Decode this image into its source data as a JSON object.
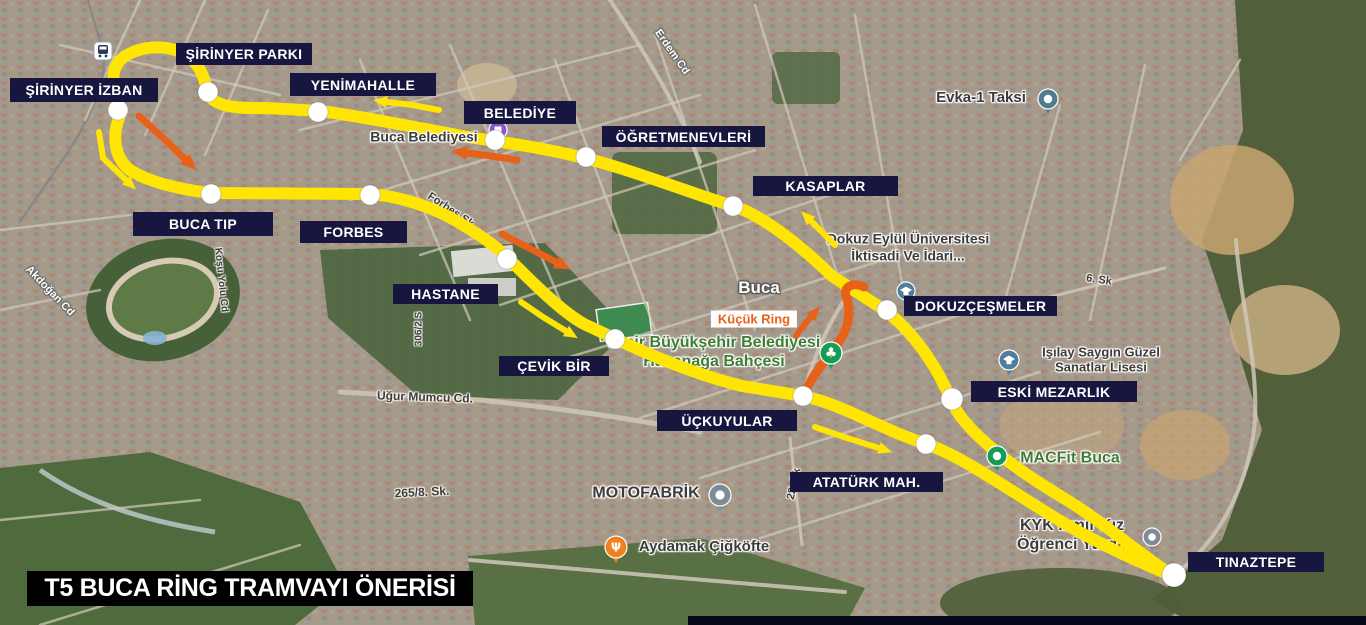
{
  "title_bar": {
    "text": "T5 BUCA RİNG TRAMVAYI ÖNERİSİ",
    "bg": "#000000",
    "fg": "#FFFFFF"
  },
  "colors": {
    "route_yellow": "#FFE504",
    "route_orange": "#E8611A",
    "station_box": "#16163F",
    "station_text": "#FFFFFF",
    "poi_green": "#3E7D33",
    "kucuk_ring_bg": "#FFFFFF"
  },
  "route": {
    "width": 12,
    "north_path": "M122,111 C112,92 108,68 124,57 C142,45 168,44 186,55 C200,64 204,77 208,92 C211,105 232,109 266,108 L321,111 C365,117 425,129 462,136 L494,141 C522,145 556,151 584,158 C624,167 702,197 733,206 C760,214 798,243 832,276 L886,311 C912,331 936,364 951,400 C964,431 1012,467 1062,497 C1102,521 1142,556 1173,576",
    "south_path": "M122,111 C112,131 112,156 130,170 C148,182 182,190 211,193 L371,194 C402,197 433,207 458,222 C483,237 497,247 509,259 C532,282 562,312 584,324 L616,339 C652,356 694,374 742,386 L803,396 C842,404 878,428 926,444 C962,456 1012,492 1062,522 C1102,546 1144,564 1173,576",
    "kucuk_ring": {
      "width": 9,
      "path": "M803,397 C812,374 828,358 840,340 C851,324 850,306 846,296 C843,288 852,281 864,287",
      "label": {
        "text": "Küçük Ring",
        "x": 754,
        "y": 319
      }
    }
  },
  "stations": [
    {
      "id": "sirinyer-izban",
      "name": "ŞİRİNYER İZBAN",
      "box": [
        10,
        78,
        148,
        24
      ],
      "dot": [
        118,
        110
      ]
    },
    {
      "id": "sirinyer-parki",
      "name": "ŞİRİNYER PARKI",
      "box": [
        176,
        43,
        136,
        22
      ],
      "dot": [
        208,
        92
      ]
    },
    {
      "id": "yenimahalle",
      "name": "YENİMAHALLE",
      "box": [
        290,
        73,
        146,
        23
      ],
      "dot": [
        318,
        112
      ]
    },
    {
      "id": "belediye",
      "name": "BELEDİYE",
      "box": [
        464,
        101,
        112,
        23
      ],
      "dot": [
        495,
        140
      ]
    },
    {
      "id": "ogretmenevleri",
      "name": "ÖĞRETMENEVLERİ",
      "box": [
        602,
        126,
        163,
        21
      ],
      "dot": [
        586,
        157
      ]
    },
    {
      "id": "kasaplar",
      "name": "KASAPLAR",
      "box": [
        753,
        176,
        145,
        20
      ],
      "dot": [
        733,
        206
      ]
    },
    {
      "id": "buca-tip",
      "name": "BUCA TIP",
      "box": [
        133,
        212,
        140,
        24
      ],
      "dot": [
        211,
        194
      ]
    },
    {
      "id": "forbes",
      "name": "FORBES",
      "box": [
        300,
        221,
        107,
        22
      ],
      "dot": [
        370,
        195
      ]
    },
    {
      "id": "hastane",
      "name": "HASTANE",
      "box": [
        393,
        284,
        105,
        20
      ],
      "dot": [
        507,
        259
      ]
    },
    {
      "id": "cevik-bir",
      "name": "ÇEVİK BİR",
      "box": [
        499,
        356,
        110,
        20
      ],
      "dot": [
        615,
        339
      ]
    },
    {
      "id": "uckuyular",
      "name": "ÜÇKUYULAR",
      "box": [
        657,
        410,
        140,
        21
      ],
      "dot": [
        803,
        396
      ]
    },
    {
      "id": "ataturk-mah",
      "name": "ATATÜRK MAH.",
      "box": [
        790,
        472,
        153,
        20
      ],
      "dot": [
        926,
        444
      ]
    },
    {
      "id": "dokuzcesmeler",
      "name": "DOKUZÇEŞMELER",
      "box": [
        904,
        296,
        153,
        20
      ],
      "dot": [
        887,
        310
      ]
    },
    {
      "id": "eski-mezarlik",
      "name": "ESKİ MEZARLIK",
      "box": [
        971,
        381,
        166,
        21
      ],
      "dot": [
        952,
        399
      ],
      "r": 11
    },
    {
      "id": "tinaztepe",
      "name": "TINAZTEPE",
      "box": [
        1188,
        552,
        136,
        20
      ],
      "dot": [
        1174,
        575
      ],
      "r": 12
    }
  ],
  "arrows": [
    {
      "id": "izban-loop-arrow-yellow",
      "color": "yellow",
      "w": 6,
      "pts": [
        [
          99,
          132
        ],
        [
          103,
          158
        ],
        [
          126,
          180
        ]
      ]
    },
    {
      "id": "yenimahalle-left-arrow-yellow",
      "color": "yellow",
      "w": 6,
      "pts": [
        [
          439,
          110
        ],
        [
          412,
          105
        ],
        [
          387,
          102
        ]
      ]
    },
    {
      "id": "kasaplar-up-arrow-yellow",
      "color": "yellow",
      "w": 6,
      "pts": [
        [
          835,
          245
        ],
        [
          823,
          233
        ],
        [
          811,
          221
        ]
      ]
    },
    {
      "id": "hastane-down-arrow-yellow",
      "color": "yellow",
      "w": 6,
      "pts": [
        [
          521,
          302
        ],
        [
          543,
          317
        ],
        [
          566,
          331
        ]
      ]
    },
    {
      "id": "ataturk-right-arrow-yellow",
      "color": "yellow",
      "w": 6,
      "pts": [
        [
          815,
          427
        ],
        [
          847,
          438
        ],
        [
          879,
          448
        ]
      ]
    },
    {
      "id": "sirinyer-down-arrow-orange",
      "color": "orange",
      "w": 7,
      "pts": [
        [
          139,
          116
        ],
        [
          161,
          136
        ],
        [
          185,
          159
        ]
      ]
    },
    {
      "id": "belediye-left-arrow-orange",
      "color": "orange",
      "w": 7,
      "pts": [
        [
          517,
          160
        ],
        [
          491,
          156
        ],
        [
          467,
          153
        ]
      ]
    },
    {
      "id": "forbes-down-arrow-orange",
      "color": "orange",
      "w": 7,
      "pts": [
        [
          502,
          234
        ],
        [
          529,
          248
        ],
        [
          556,
          262
        ]
      ]
    },
    {
      "id": "kucukring-up-arrow-orange",
      "color": "orange",
      "w": 6,
      "pts": [
        [
          796,
          336
        ],
        [
          804,
          325
        ],
        [
          811,
          317
        ]
      ]
    }
  ],
  "map_pois": [
    {
      "id": "buca-belediyesi-label",
      "lines": [
        "Buca Belediyesi"
      ],
      "x": 424,
      "y": 137,
      "size": 14,
      "variant": "dark",
      "above": true
    },
    {
      "id": "evka1-taksi-label",
      "lines": [
        "Evka-1 Taksi"
      ],
      "x": 981,
      "y": 98,
      "size": 15,
      "variant": "dark"
    },
    {
      "id": "deu-iktisadi-label",
      "lines": [
        "Dokuz Eylül Üniversitesi",
        "İktisadi Ve İdari..."
      ],
      "x": 908,
      "y": 247,
      "size": 14,
      "variant": "dark"
    },
    {
      "id": "buca-district-label",
      "lines": [
        "Buca"
      ],
      "x": 759,
      "y": 288,
      "size": 17,
      "variant": "light"
    },
    {
      "id": "isilay-saygin-label",
      "lines": [
        "Işılay Saygın Güzel",
        "Sanatlar Lisesi"
      ],
      "x": 1101,
      "y": 360,
      "size": 13,
      "variant": "dark"
    },
    {
      "id": "hasanaga-bahcesi-label",
      "lines": [
        "İzmir Büyükşehir Belediyesi",
        "Hasanağa Bahçesi"
      ],
      "x": 714,
      "y": 353,
      "size": 16,
      "variant": "green"
    },
    {
      "id": "macfit-buca-label",
      "lines": [
        "MACFit Buca"
      ],
      "x": 1070,
      "y": 459,
      "size": 16,
      "variant": "green"
    },
    {
      "id": "kyk-yurdu-label",
      "lines": [
        "KYK İzmir Kız",
        "Öğrenci Yurdu"
      ],
      "x": 1072,
      "y": 536,
      "size": 16,
      "variant": "dark"
    },
    {
      "id": "motofabrik-label",
      "lines": [
        "MOTOFABRİK"
      ],
      "x": 646,
      "y": 494,
      "size": 16,
      "variant": "dark"
    },
    {
      "id": "aydamak-label",
      "lines": [
        "Aydamak Çiğköfte"
      ],
      "x": 704,
      "y": 547,
      "size": 15,
      "variant": "dark"
    }
  ],
  "streets": [
    {
      "id": "erdem-cd",
      "text": "Erdem Cd",
      "x": 672,
      "y": 52,
      "angle": 55,
      "variant": "light",
      "size": 11
    },
    {
      "id": "akdogan-cd",
      "text": "Akdoğan Cd",
      "x": 50,
      "y": 291,
      "angle": 46,
      "variant": "light",
      "size": 11
    },
    {
      "id": "kosu-yolu-cd",
      "text": "Koşu Yolu Cd",
      "x": 221,
      "y": 280,
      "angle": 84,
      "variant": "dark",
      "size": 10
    },
    {
      "id": "forbes-sk",
      "text": "Forbes Sk.",
      "x": 452,
      "y": 211,
      "angle": 34,
      "variant": "dark",
      "size": 11
    },
    {
      "id": "street-306-2",
      "text": "306/2 S",
      "x": 419,
      "y": 329,
      "angle": -90,
      "variant": "dark",
      "size": 10
    },
    {
      "id": "ugur-mumcu-cd",
      "text": "Uğur Mumcu Cd.",
      "x": 425,
      "y": 397,
      "angle": 2,
      "variant": "dark",
      "size": 12
    },
    {
      "id": "street-265-8",
      "text": "265/8. Sk.",
      "x": 422,
      "y": 492,
      "angle": -3,
      "variant": "dark",
      "size": 12
    },
    {
      "id": "street-22-sk",
      "text": "22. Sk",
      "x": 794,
      "y": 484,
      "angle": -78,
      "variant": "dark",
      "size": 11
    },
    {
      "id": "street-6-sk",
      "text": "6. Sk",
      "x": 1099,
      "y": 280,
      "angle": 8,
      "variant": "dark",
      "size": 11
    }
  ],
  "icons": [
    {
      "id": "izban-train-station-icon",
      "type": "train",
      "x": 103,
      "y": 51
    },
    {
      "id": "belediye-pin-icon",
      "type": "pin",
      "glyph": "square",
      "color": "#8A56C8",
      "x": 498,
      "y": 130,
      "r": 9
    },
    {
      "id": "evka1-taksi-pin-icon",
      "type": "pin",
      "glyph": "dot",
      "color": "#4F7E8F",
      "x": 1048,
      "y": 99,
      "r": 10
    },
    {
      "id": "deu-school-icon",
      "type": "pin",
      "glyph": "cap",
      "color": "#517E9E",
      "x": 906,
      "y": 291,
      "r": 9
    },
    {
      "id": "isilay-school-icon",
      "type": "pin",
      "glyph": "cap",
      "color": "#517E9E",
      "x": 1009,
      "y": 360,
      "r": 10
    },
    {
      "id": "hasanaga-park-icon",
      "type": "pin",
      "glyph": "club",
      "color": "#169C54",
      "x": 831,
      "y": 353,
      "r": 11
    },
    {
      "id": "macfit-pin-icon",
      "type": "pin",
      "glyph": "dot",
      "color": "#169C54",
      "x": 997,
      "y": 456,
      "r": 10
    },
    {
      "id": "motofabrik-pin-icon",
      "type": "pin",
      "glyph": "dot",
      "color": "#7E8C95",
      "x": 720,
      "y": 495,
      "r": 11
    },
    {
      "id": "kyk-pin-icon",
      "type": "pin",
      "glyph": "dot",
      "color": "#7E8C95",
      "x": 1152,
      "y": 537,
      "r": 9
    },
    {
      "id": "aydamak-restaurant-icon",
      "type": "pin",
      "glyph": "fork",
      "color": "#F0821E",
      "x": 616,
      "y": 547,
      "r": 11
    }
  ]
}
